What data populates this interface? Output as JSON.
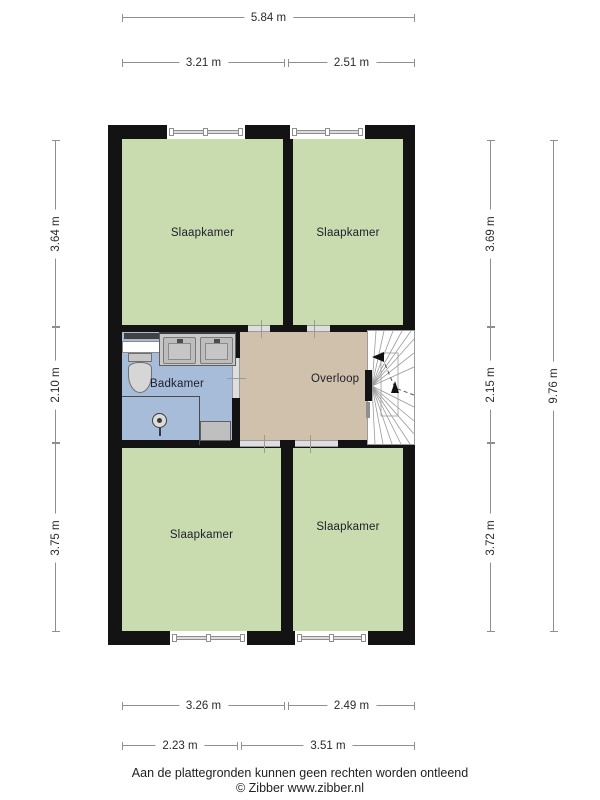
{
  "rooms": {
    "bedroom_top_left": {
      "label": "Slaapkamer"
    },
    "bedroom_top_right": {
      "label": "Slaapkamer"
    },
    "bathroom": {
      "label": "Badkamer"
    },
    "landing": {
      "label": "Overloop"
    },
    "bedroom_bottom_left": {
      "label": "Slaapkamer"
    },
    "bedroom_bottom_right": {
      "label": "Slaapkamer"
    }
  },
  "dimensions": {
    "top": {
      "total": "5.84 m",
      "left": "3.21 m",
      "right": "2.51 m"
    },
    "left": {
      "top": "3.64 m",
      "middle": "2.10 m",
      "bottom": "3.75 m"
    },
    "right": {
      "top": "3.69 m",
      "middle": "2.15 m",
      "bottom": "3.72 m",
      "total": "9.76 m"
    },
    "bottom": {
      "row1_left": "3.26 m",
      "row1_right": "2.49 m",
      "row2_left": "2.23 m",
      "row2_right": "3.51 m"
    }
  },
  "footer": {
    "disclaimer": "Aan de plattegronden kunnen geen rechten worden ontleend",
    "credit": "© Zibber www.zibber.nl"
  },
  "colors": {
    "wall": "#131313",
    "bedroom_fill": "#c8dcb0",
    "bathroom_fill": "#a7bcd9",
    "landing_fill": "#cfc1ac",
    "stairs_fill": "#ffffff",
    "fixture_gray": "#c9c9c9",
    "dimension_line": "#8f8f8f"
  }
}
